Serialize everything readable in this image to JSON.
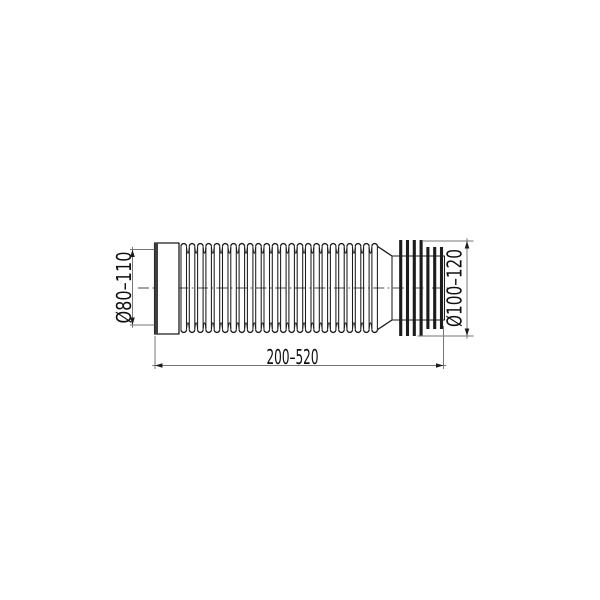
{
  "drawing": {
    "kind": "technical-drawing",
    "subject": "flexible corrugated WC connector pipe, side view",
    "labels": {
      "left_diameter": "Ø80–110",
      "right_diameter": "Ø100–120",
      "length": "200–520"
    },
    "colors": {
      "background": "#ffffff",
      "outline": "#1c1c1c",
      "dimension_lines": "#767676",
      "collar_edge_band": "#3f3f3f",
      "text": "#101010"
    },
    "geometry": {
      "centerline": {
        "x1": 138,
        "x2": 452,
        "y": 288
      },
      "collar": {
        "x": 154.6,
        "w": 24.4,
        "top": 243,
        "bottom": 334,
        "band_w": 3.4
      },
      "bellows": {
        "x_start": 181,
        "ridges": 24,
        "pitch": 8.3,
        "arch_w": 5.5,
        "wall_top": 246.3,
        "wall_bottom": 329.7,
        "valley_ctrl_top": 259,
        "valley_ctrl_bottom": 317
      },
      "sleeve": {
        "x": 392,
        "w": 52.5,
        "top": 256,
        "bottom": 320
      },
      "fins": {
        "width": 3.1,
        "tall": {
          "xs": [
            400.7,
            407.5,
            414.3,
            421.1
          ],
          "top": 240,
          "bottom": 336
        },
        "short": {
          "xs": [
            427.9,
            434.7,
            441.5
          ],
          "top": 247,
          "bottom": 329
        }
      },
      "dims": {
        "left": {
          "line_x": 132.5,
          "top_y": 249.5,
          "bot_y": 325,
          "ext_x1": 130,
          "ext_x2": 154.4,
          "overshoot": 2.8
        },
        "right": {
          "line_x": 467,
          "top_y": 241,
          "bot_y": 336,
          "ext_top_x1": 422,
          "ext_bot_x1": 417.5,
          "ext_x2": 473.5,
          "overshoot": 2.8
        },
        "bottom": {
          "line_y": 365.5,
          "left_x": 155,
          "right_x": 443.5,
          "ext_left_y1": 336,
          "ext_right_y1": 326,
          "ext_y2": 369,
          "overshoot": 2.8
        }
      },
      "arrow": {
        "len": 7.5,
        "half_w": 2.3
      }
    }
  }
}
